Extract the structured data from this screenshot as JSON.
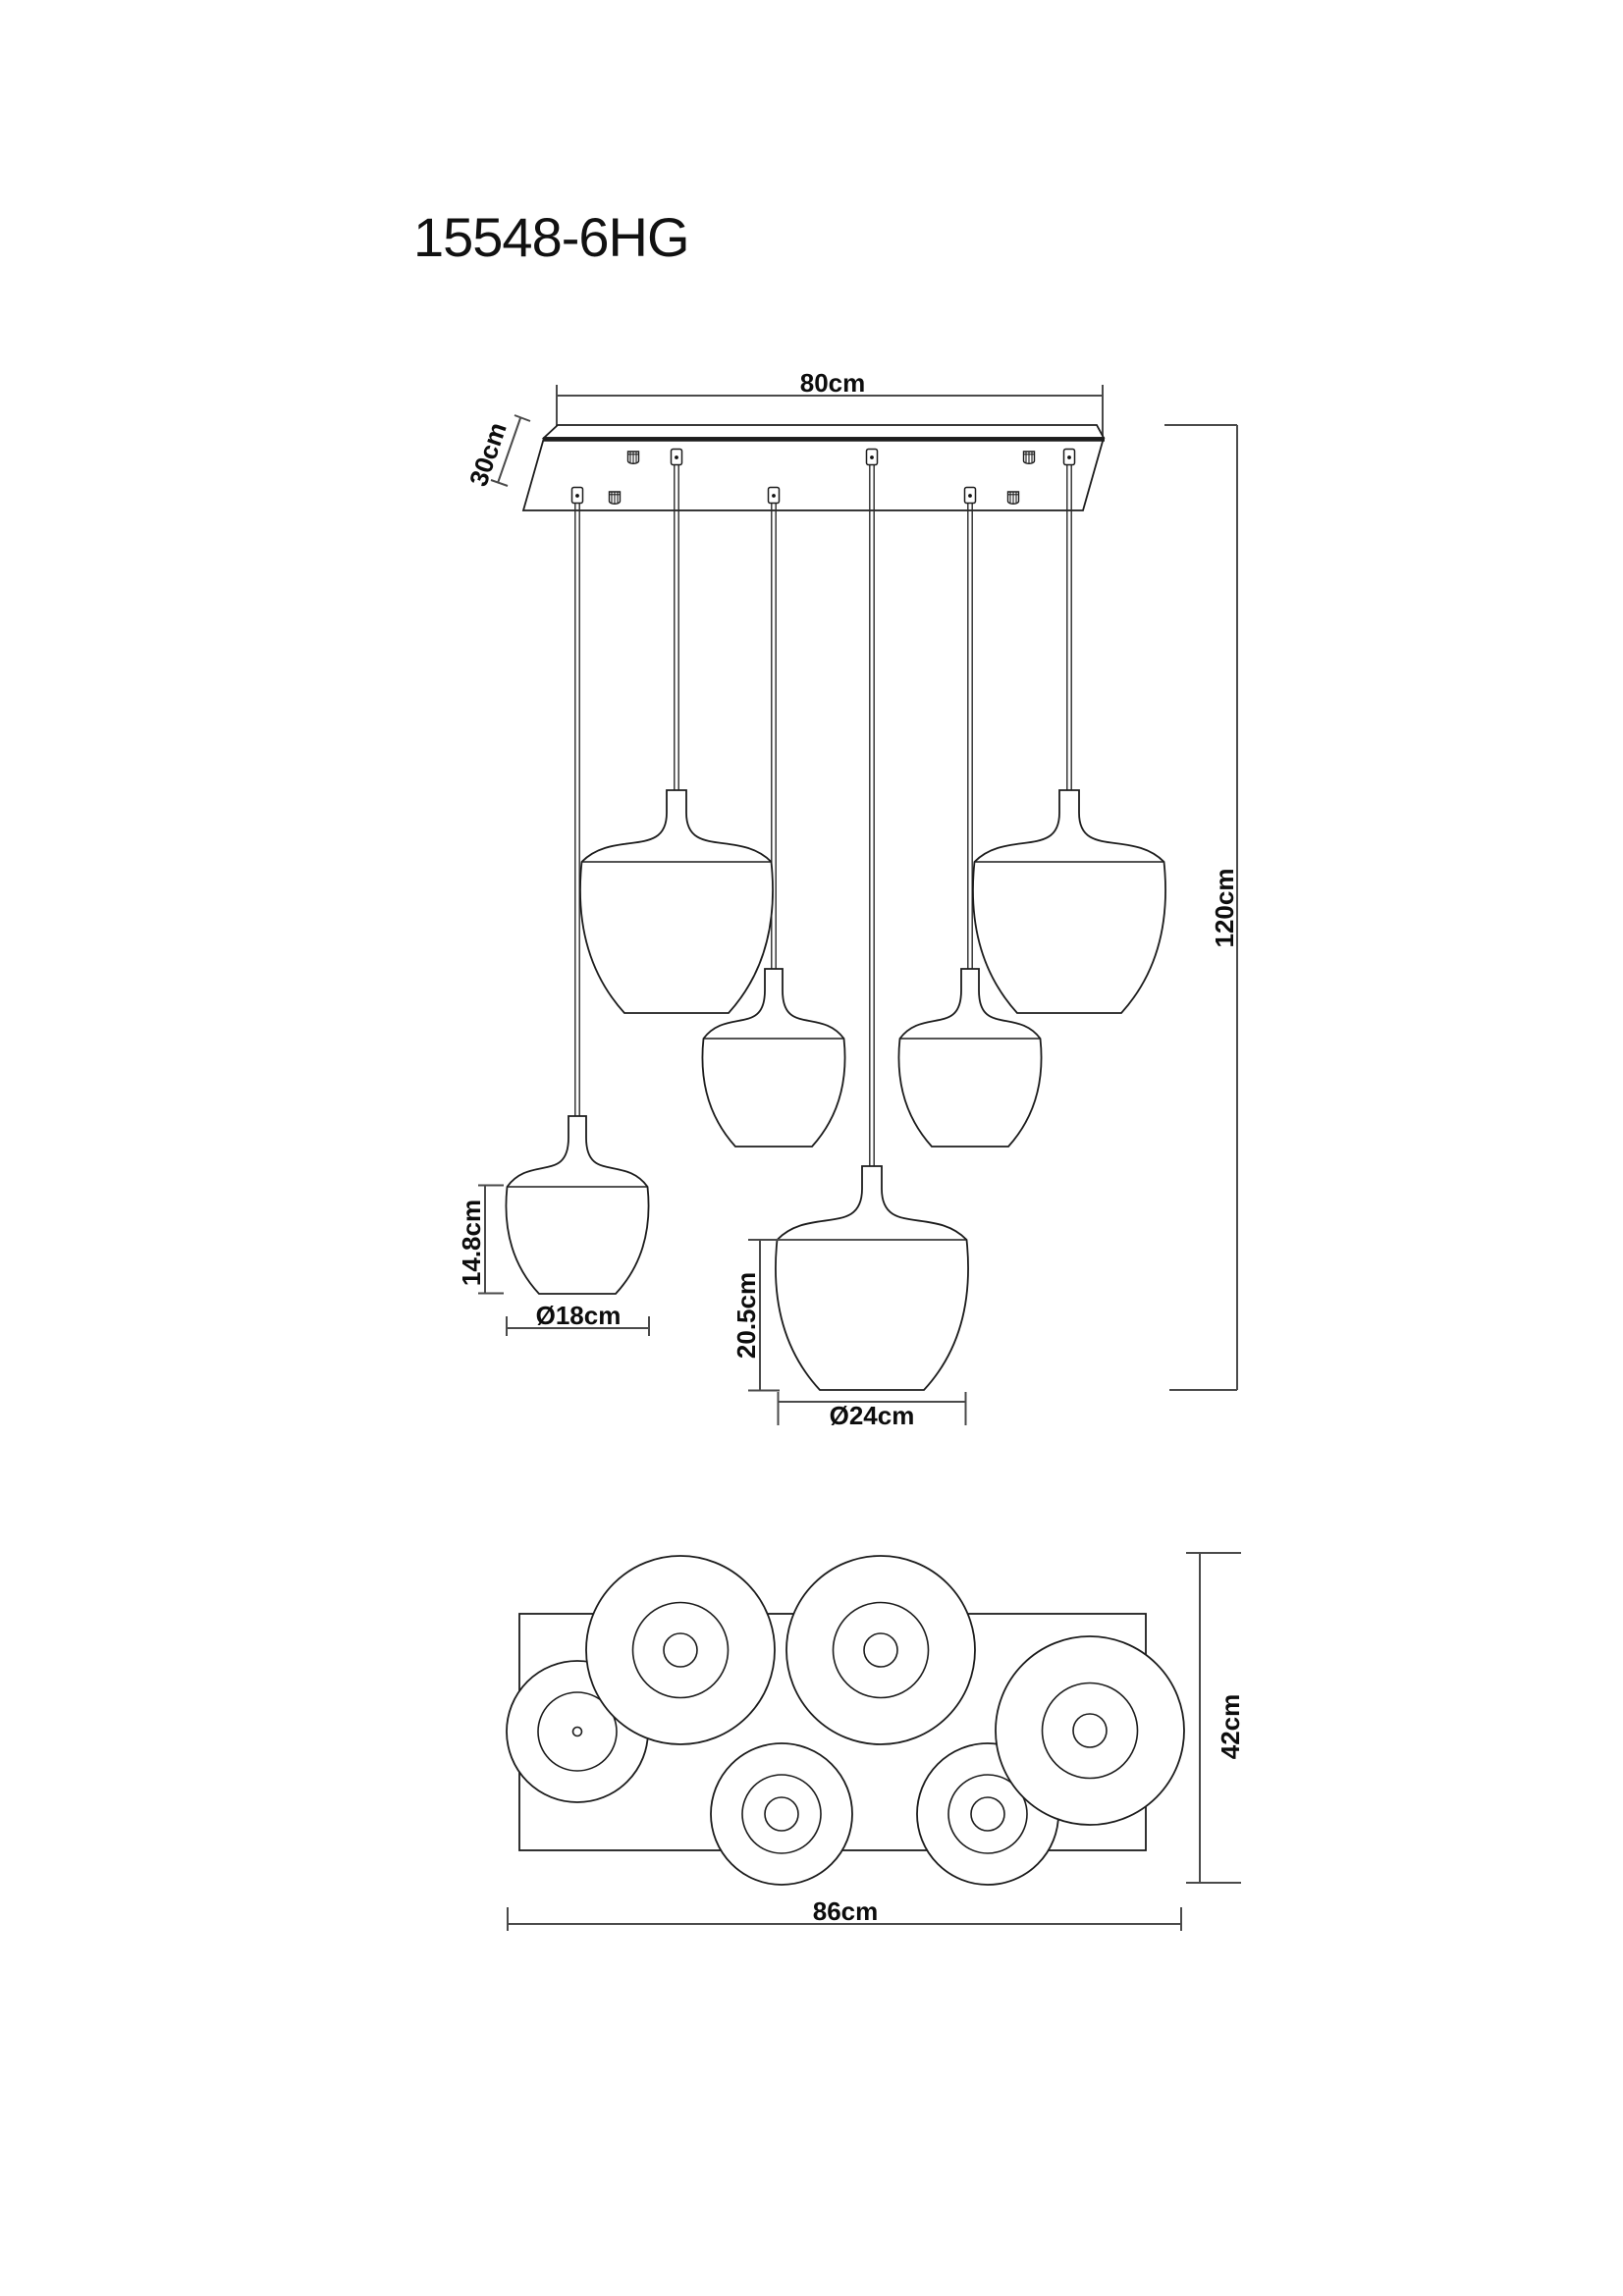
{
  "title": "15548-6HG",
  "side_view": {
    "canopy_width": "80cm",
    "canopy_depth": "30cm",
    "overall_height": "120cm",
    "small_shade_height": "14.8cm",
    "small_shade_diameter": "Ø18cm",
    "large_shade_height": "20.5cm",
    "large_shade_diameter": "Ø24cm"
  },
  "top_view": {
    "overall_width": "86cm",
    "overall_depth": "42cm"
  }
}
